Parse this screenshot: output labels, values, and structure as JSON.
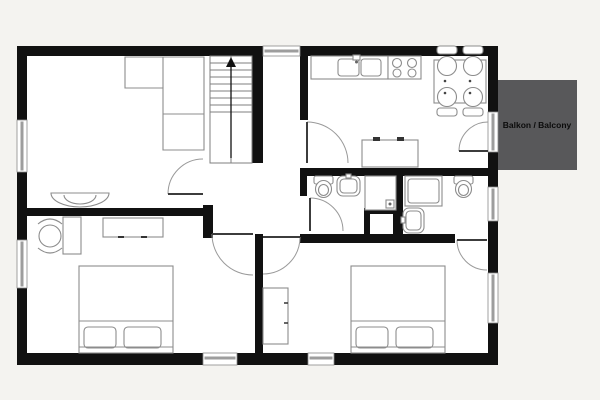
{
  "meta": {
    "background": "#f4f3f0",
    "floor_fill": "#ffffff",
    "wall_color": "#111111",
    "window_color": "#9d9d9d",
    "window_frame": "#8a8a8a",
    "furniture_stroke": "#8c8c8c",
    "door_leaf_color": "#3c3c3c",
    "door_arc_color": "#9a9a9a",
    "stair_stroke": "#7f7f7f",
    "balcony_fill": "#58585a"
  },
  "labels": {
    "balcony": "Balkon / Balcony"
  },
  "plan": {
    "floor": {
      "x": 17,
      "y": 46,
      "w": 481,
      "h": 319
    },
    "balcony": {
      "x": 498,
      "y": 80,
      "w": 79,
      "h": 90,
      "label_x": 537,
      "label_y": 128
    },
    "walls": [
      {
        "x": 17,
        "y": 46,
        "w": 246,
        "h": 10
      },
      {
        "x": 300,
        "y": 46,
        "w": 198,
        "h": 10
      },
      {
        "x": 17,
        "y": 46,
        "w": 10,
        "h": 74
      },
      {
        "x": 17,
        "y": 172,
        "w": 10,
        "h": 68
      },
      {
        "x": 17,
        "y": 288,
        "w": 10,
        "h": 77
      },
      {
        "x": 17,
        "y": 353,
        "w": 186,
        "h": 12
      },
      {
        "x": 237,
        "y": 353,
        "w": 71,
        "h": 12
      },
      {
        "x": 334,
        "y": 353,
        "w": 164,
        "h": 12
      },
      {
        "x": 488,
        "y": 46,
        "w": 10,
        "h": 66
      },
      {
        "x": 488,
        "y": 152,
        "w": 10,
        "h": 35
      },
      {
        "x": 488,
        "y": 221,
        "w": 10,
        "h": 52
      },
      {
        "x": 488,
        "y": 323,
        "w": 10,
        "h": 42
      },
      {
        "x": 300,
        "y": 56,
        "w": 8,
        "h": 64
      },
      {
        "x": 252,
        "y": 56,
        "w": 11,
        "h": 107
      },
      {
        "x": 17,
        "y": 208,
        "w": 186,
        "h": 8
      },
      {
        "x": 203,
        "y": 205,
        "w": 10,
        "h": 33
      },
      {
        "x": 255,
        "y": 234,
        "w": 8,
        "h": 119
      },
      {
        "x": 300,
        "y": 168,
        "w": 198,
        "h": 8
      },
      {
        "x": 300,
        "y": 176,
        "w": 7,
        "h": 20
      },
      {
        "x": 396,
        "y": 168,
        "w": 7,
        "h": 75
      },
      {
        "x": 300,
        "y": 234,
        "w": 155,
        "h": 9
      },
      {
        "x": 364,
        "y": 208,
        "w": 35,
        "h": 35
      },
      {
        "x": 370,
        "y": 214,
        "w": 23,
        "h": 20,
        "c": "#ffffff"
      }
    ],
    "windows": [
      {
        "o": "v",
        "x": 17,
        "y": 120,
        "w": 10,
        "h": 52
      },
      {
        "o": "v",
        "x": 17,
        "y": 240,
        "w": 10,
        "h": 48
      },
      {
        "o": "h",
        "x": 263,
        "y": 46,
        "w": 37,
        "h": 10
      },
      {
        "o": "h",
        "x": 203,
        "y": 353,
        "w": 34,
        "h": 12
      },
      {
        "o": "h",
        "x": 308,
        "y": 353,
        "w": 26,
        "h": 12
      },
      {
        "o": "v",
        "x": 488,
        "y": 112,
        "w": 10,
        "h": 40
      },
      {
        "o": "v",
        "x": 488,
        "y": 187,
        "w": 10,
        "h": 34
      },
      {
        "o": "v",
        "x": 488,
        "y": 273,
        "w": 10,
        "h": 50
      }
    ],
    "doors": [
      {
        "name": "door-hall-living",
        "leaf": [
          168,
          194,
          203,
          194
        ],
        "arc": "M168,194 A35,35 0 0 1 203,159"
      },
      {
        "name": "door-kitchen",
        "leaf": [
          307,
          122,
          307,
          163
        ],
        "arc": "M307,122 A41,41 0 0 1 348,163"
      },
      {
        "name": "door-balcony",
        "leaf": [
          459,
          151,
          488,
          151
        ],
        "arc": "M459,151 A29,29 0 0 1 488,122"
      },
      {
        "name": "door-wc",
        "leaf": [
          310,
          198,
          310,
          231
        ],
        "arc": "M310,198 A33,33 0 0 1 343,231"
      },
      {
        "name": "door-bedroom-1",
        "leaf": [
          212,
          234,
          253,
          234
        ],
        "arc": "M212,234 A41,41 0 0 0 253,275"
      },
      {
        "name": "door-bedroom-2",
        "leaf": [
          300,
          237,
          263,
          237
        ],
        "arc": "M300,237 A37,37 0 0 1 263,274"
      },
      {
        "name": "door-ensuite",
        "leaf": [
          457,
          240,
          487,
          240
        ],
        "arc": "M457,240 A30,30 0 0 0 487,270"
      }
    ],
    "stairs": {
      "x": 210,
      "y": 56,
      "w": 42,
      "h": 107,
      "treads": [
        63,
        70,
        77,
        84,
        91,
        98,
        105,
        112
      ],
      "center_x": 231,
      "arrow": {
        "tip": [
          231,
          57
        ],
        "left": [
          226,
          67
        ],
        "right": [
          236,
          67
        ],
        "stem_y2": 158
      }
    },
    "furniture": [
      {
        "name": "corner-sofa",
        "prims": [
          {
            "t": "path",
            "d": "M125,57 H204 V150 H163 V88 H125 Z",
            "f": "#ffffff"
          },
          {
            "t": "line",
            "x1": 163,
            "y1": 57,
            "x2": 163,
            "y2": 88
          },
          {
            "t": "line",
            "x1": 163,
            "y1": 114,
            "x2": 204,
            "y2": 114
          }
        ]
      },
      {
        "name": "console-table",
        "prims": [
          {
            "t": "path",
            "d": "M51,193 H109 A29,14 0 0 1 51,193 Z",
            "f": "#ffffff"
          },
          {
            "t": "path",
            "d": "M96,195 A16,9 0 0 1 64,195"
          }
        ]
      },
      {
        "name": "desk",
        "prims": [
          {
            "t": "rect",
            "x": 63,
            "y": 217,
            "w": 18,
            "h": 37
          }
        ]
      },
      {
        "name": "desk-chair",
        "prims": [
          {
            "t": "circle",
            "cx": 50,
            "cy": 236,
            "r": 11
          },
          {
            "t": "path",
            "d": "M38,224 Q50,214 62,224"
          },
          {
            "t": "path",
            "d": "M38,248 Q50,258 62,248"
          }
        ]
      },
      {
        "name": "dresser",
        "prims": [
          {
            "t": "rect",
            "x": 103,
            "y": 218,
            "w": 60,
            "h": 19
          },
          {
            "t": "line",
            "x1": 118,
            "y1": 237,
            "x2": 124,
            "y2": 237,
            "s": "#333333",
            "sw": 2
          },
          {
            "t": "line",
            "x1": 141,
            "y1": 237,
            "x2": 147,
            "y2": 237,
            "s": "#333333",
            "sw": 2
          }
        ]
      },
      {
        "name": "double-bed-1",
        "prims": [
          {
            "t": "rect",
            "x": 79,
            "y": 266,
            "w": 94,
            "h": 87
          },
          {
            "t": "line",
            "x1": 79,
            "y1": 321,
            "x2": 173,
            "y2": 321
          },
          {
            "t": "rect",
            "x": 84,
            "y": 327,
            "w": 32,
            "h": 21,
            "rx": 4
          },
          {
            "t": "rect",
            "x": 124,
            "y": 327,
            "w": 37,
            "h": 21,
            "rx": 4
          },
          {
            "t": "line",
            "x1": 79,
            "y1": 347,
            "x2": 173,
            "y2": 347
          }
        ]
      },
      {
        "name": "wardrobe",
        "prims": [
          {
            "t": "rect",
            "x": 263,
            "y": 288,
            "w": 25,
            "h": 56
          },
          {
            "t": "line",
            "x1": 284,
            "y1": 303,
            "x2": 288,
            "y2": 303,
            "s": "#333333",
            "sw": 1.5
          },
          {
            "t": "line",
            "x1": 284,
            "y1": 323,
            "x2": 288,
            "y2": 323,
            "s": "#333333",
            "sw": 1.5
          }
        ]
      },
      {
        "name": "double-bed-2",
        "prims": [
          {
            "t": "rect",
            "x": 351,
            "y": 266,
            "w": 94,
            "h": 87
          },
          {
            "t": "line",
            "x1": 351,
            "y1": 321,
            "x2": 445,
            "y2": 321
          },
          {
            "t": "rect",
            "x": 356,
            "y": 327,
            "w": 32,
            "h": 21,
            "rx": 4
          },
          {
            "t": "rect",
            "x": 396,
            "y": 327,
            "w": 37,
            "h": 21,
            "rx": 4
          },
          {
            "t": "line",
            "x1": 351,
            "y1": 347,
            "x2": 445,
            "y2": 347
          }
        ]
      },
      {
        "name": "kitchen-counter-sink",
        "prims": [
          {
            "t": "rect",
            "x": 311,
            "y": 56,
            "w": 77,
            "h": 23
          },
          {
            "t": "rect",
            "x": 338,
            "y": 59,
            "w": 21,
            "h": 17,
            "rx": 3
          },
          {
            "t": "rect",
            "x": 361,
            "y": 59,
            "w": 20,
            "h": 17,
            "rx": 3
          },
          {
            "t": "rect",
            "x": 353,
            "y": 55,
            "w": 7,
            "h": 5
          },
          {
            "t": "circle",
            "cx": 356.5,
            "cy": 62,
            "r": 1.5,
            "f": "#666666",
            "s": "none"
          }
        ]
      },
      {
        "name": "stove",
        "prims": [
          {
            "t": "rect",
            "x": 388,
            "y": 56,
            "w": 33,
            "h": 23
          },
          {
            "t": "circle",
            "cx": 397,
            "cy": 63,
            "r": 4.5
          },
          {
            "t": "circle",
            "cx": 412,
            "cy": 63,
            "r": 4.5
          },
          {
            "t": "circle",
            "cx": 397,
            "cy": 73,
            "r": 4
          },
          {
            "t": "circle",
            "cx": 412,
            "cy": 73,
            "r": 4
          }
        ]
      },
      {
        "name": "dining-table",
        "prims": [
          {
            "t": "rect",
            "x": 434,
            "y": 60,
            "w": 52,
            "h": 43
          }
        ]
      },
      {
        "name": "dining-chairs",
        "prims": [
          {
            "t": "rect",
            "x": 437,
            "y": 46,
            "w": 20,
            "h": 8,
            "rx": 3
          },
          {
            "t": "rect",
            "x": 463,
            "y": 46,
            "w": 20,
            "h": 8,
            "rx": 3
          },
          {
            "t": "rect",
            "x": 437,
            "y": 108,
            "w": 20,
            "h": 8,
            "rx": 3
          },
          {
            "t": "rect",
            "x": 463,
            "y": 108,
            "w": 20,
            "h": 8,
            "rx": 3
          },
          {
            "t": "circle",
            "cx": 447,
            "cy": 66,
            "r": 9.5
          },
          {
            "t": "circle",
            "cx": 473,
            "cy": 66,
            "r": 9.5
          },
          {
            "t": "circle",
            "cx": 447,
            "cy": 97,
            "r": 9.5
          },
          {
            "t": "circle",
            "cx": 473,
            "cy": 97,
            "r": 9.5
          },
          {
            "t": "circle",
            "cx": 445,
            "cy": 81,
            "r": 1.3,
            "f": "#444444",
            "s": "none"
          },
          {
            "t": "circle",
            "cx": 470,
            "cy": 81,
            "r": 1.3,
            "f": "#444444",
            "s": "none"
          },
          {
            "t": "circle",
            "cx": 445,
            "cy": 93,
            "r": 1.3,
            "f": "#444444",
            "s": "none"
          },
          {
            "t": "circle",
            "cx": 470,
            "cy": 93,
            "r": 1.3,
            "f": "#444444",
            "s": "none"
          }
        ]
      },
      {
        "name": "sideboard",
        "prims": [
          {
            "t": "rect",
            "x": 362,
            "y": 140,
            "w": 56,
            "h": 27
          },
          {
            "t": "rect",
            "x": 373,
            "y": 137,
            "w": 7,
            "h": 4,
            "f": "#333333",
            "s": "none"
          },
          {
            "t": "rect",
            "x": 397,
            "y": 137,
            "w": 7,
            "h": 4,
            "f": "#333333",
            "s": "none"
          }
        ]
      },
      {
        "name": "toilet-wc",
        "prims": [
          {
            "t": "rect",
            "x": 314,
            "y": 176,
            "w": 19,
            "h": 8,
            "rx": 2
          },
          {
            "t": "ellipse",
            "cx": 323.5,
            "cy": 189,
            "rx": 8,
            "ry": 8.5
          },
          {
            "t": "ellipse",
            "cx": 323.5,
            "cy": 190,
            "rx": 5,
            "ry": 5.5
          }
        ]
      },
      {
        "name": "washbasin-wc",
        "prims": [
          {
            "t": "rect",
            "x": 337,
            "y": 176,
            "w": 23,
            "h": 20,
            "rx": 6
          },
          {
            "t": "rect",
            "x": 340,
            "y": 179,
            "w": 17,
            "h": 14,
            "rx": 4
          },
          {
            "t": "rect",
            "x": 346,
            "y": 174,
            "w": 5,
            "h": 4
          }
        ]
      },
      {
        "name": "shower",
        "prims": [
          {
            "t": "rect",
            "x": 365,
            "y": 176,
            "w": 31,
            "h": 34
          },
          {
            "t": "rect",
            "x": 386,
            "y": 200,
            "w": 8,
            "h": 8
          },
          {
            "t": "circle",
            "cx": 390,
            "cy": 204,
            "r": 1.5,
            "f": "#666666",
            "s": "none"
          }
        ]
      },
      {
        "name": "bathtub-ensuite",
        "prims": [
          {
            "t": "rect",
            "x": 405,
            "y": 176,
            "w": 37,
            "h": 30
          },
          {
            "t": "rect",
            "x": 408,
            "y": 179,
            "w": 31,
            "h": 24,
            "rx": 3
          }
        ]
      },
      {
        "name": "toilet-ensuite",
        "prims": [
          {
            "t": "rect",
            "x": 454,
            "y": 176,
            "w": 19,
            "h": 8,
            "rx": 2
          },
          {
            "t": "ellipse",
            "cx": 463.5,
            "cy": 189,
            "rx": 8,
            "ry": 8.5
          },
          {
            "t": "ellipse",
            "cx": 463.5,
            "cy": 190,
            "rx": 5,
            "ry": 5.5
          }
        ]
      },
      {
        "name": "washbasin-ensuite",
        "prims": [
          {
            "t": "rect",
            "x": 403,
            "y": 208,
            "w": 21,
            "h": 25,
            "rx": 6
          },
          {
            "t": "rect",
            "x": 406,
            "y": 211,
            "w": 15,
            "h": 19,
            "rx": 4
          },
          {
            "t": "rect",
            "x": 401,
            "y": 217,
            "w": 4,
            "h": 6
          }
        ]
      }
    ]
  }
}
